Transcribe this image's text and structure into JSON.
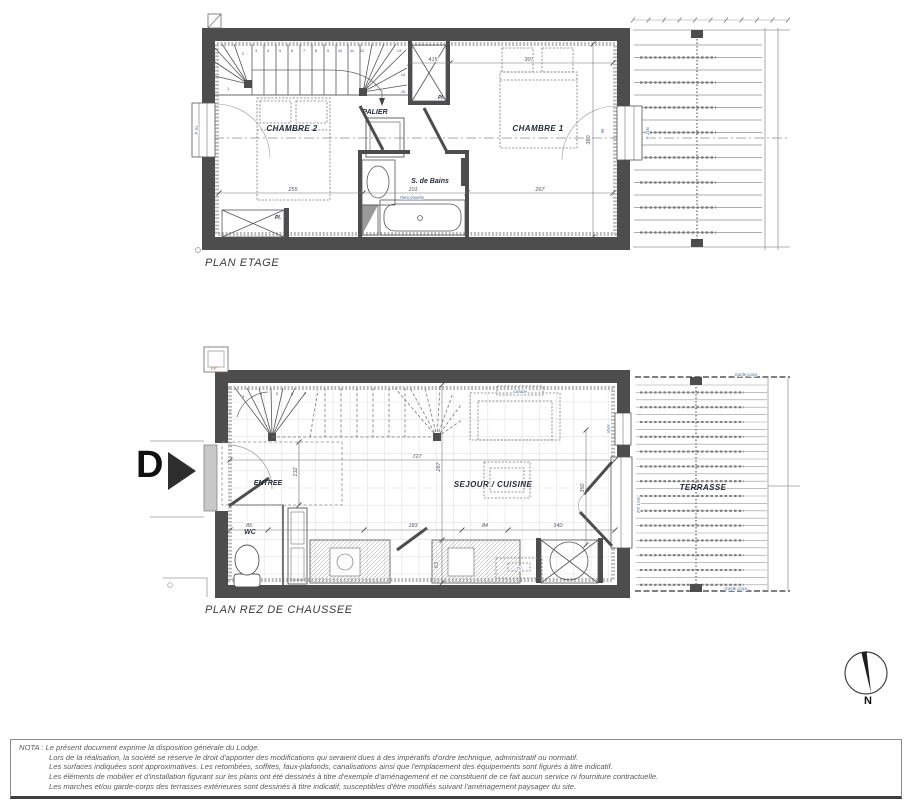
{
  "colors": {
    "wall": "#4d4d4d",
    "line": "#555555",
    "insulation": "#b8b8b8",
    "label": "#242b3a",
    "dim_text": "#4e5560",
    "accent_blue": "#4a6f9f",
    "accent_red": "#b04030"
  },
  "upper_plan": {
    "title": "PLAN ETAGE",
    "labels": {
      "chambre2": "CHAMBRE 2",
      "palier": "PALIER",
      "sdb": "S. de Bains",
      "chambre1": "CHAMBRE 1",
      "pl_top": "Pl.",
      "pl_bottom": "Pl.",
      "pare_douche": "Pare douche",
      "window_left": "F. Av",
      "window_right": "F. 2vtx"
    },
    "dimensions": {
      "d255": "255",
      "d101": "101",
      "d267": "267",
      "d415": "415",
      "d307": "307",
      "d380": "380",
      "d96": "96"
    },
    "stair_numbers": [
      "1",
      "2",
      "3",
      "4",
      "5",
      "6",
      "7",
      "8",
      "9",
      "10",
      "11",
      "12",
      "13",
      "14",
      "15"
    ]
  },
  "ground_plan": {
    "title": "PLAN REZ DE CHAUSSEE",
    "door_marker": "D",
    "labels": {
      "entree": "ENTREE",
      "wc": "WC",
      "sejour": "SEJOUR / CUISINE",
      "terrasse": "TERRASSE",
      "canape": "canapé",
      "tv": "TV",
      "garde_corps_top": "Garde corps",
      "garde_corps_bottom": "Garde corps",
      "window_top_right": "VtxH",
      "door_right": "P.F 1Vtx",
      "ff": "F.F"
    },
    "dimensions": {
      "d727": "727",
      "d287": "287",
      "d132": "132",
      "d85": "85",
      "d183": "183",
      "d84": "84",
      "d340": "340",
      "d350": "350",
      "d63": "63"
    },
    "stair_numbers": [
      "1",
      "2",
      "3",
      "4",
      "5",
      "6",
      "7"
    ]
  },
  "compass": {
    "north_label": "N"
  },
  "nota": {
    "prefix": "NOTA :",
    "lines": [
      "Le présent document exprime la disposition générale du Lodge.",
      "Lors de la réalisation, la société se réserve le droit d'apporter des modifications qui seraient dues à des impératifs d'ordre technique, administratif ou normatif.",
      "Les surfaces indiquées sont approximatives. Les retombées, soffites, faux-plafonds, canalisations ainsi que l'emplacement des équipements sont figurés à titre indicatif.",
      "Les éléments de mobilier et d'installation figurant sur les plans ont été dessinés à titre d'exemple d'aménagement et ne constituent de ce fait aucun service ni fourniture contractuelle.",
      "Les marches et/ou garde-corps des terrasses extérieures sont dessinés à titre indicatif, susceptibles d'être modifiés suivant l'aménagement paysager du site."
    ]
  }
}
